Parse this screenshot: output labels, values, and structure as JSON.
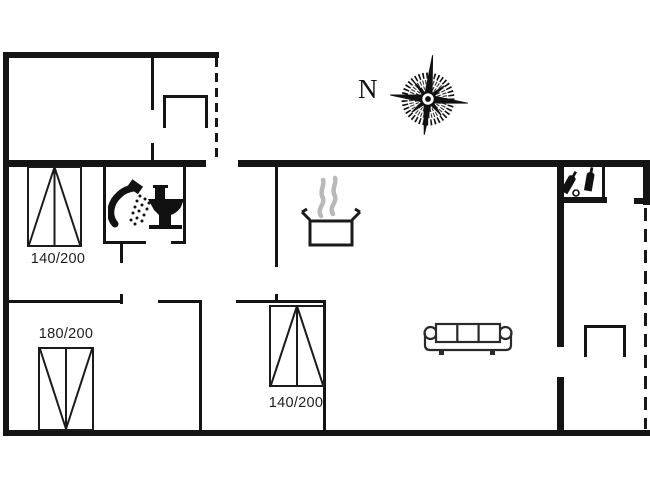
{
  "page": {
    "type": "floor-plan",
    "background": "#ffffff"
  },
  "compass": {
    "north_label": "N"
  },
  "beds": [
    {
      "name": "double-bed-top-left",
      "size_label": "140/200"
    },
    {
      "name": "double-bed-bottom-left",
      "size_label": "180/200"
    },
    {
      "name": "double-bed-bottom-middle",
      "size_label": "140/200"
    }
  ],
  "icons": {
    "compass_rose": "compass-rose",
    "cooking_pot": "cooking-pot-with-steam",
    "shower": "shower-head-with-spray",
    "toilet": "toilet-side-view",
    "bottles": "wine-bottles-in-closet",
    "sofa": "three-seat-sofa",
    "entrance_steps": "entrance-steps",
    "terrace_steps": "terrace-steps"
  },
  "colors": {
    "wall": "#141414",
    "line": "#1b1b1b",
    "steam": "#b9b9b9",
    "text": "#1f1f1f"
  }
}
